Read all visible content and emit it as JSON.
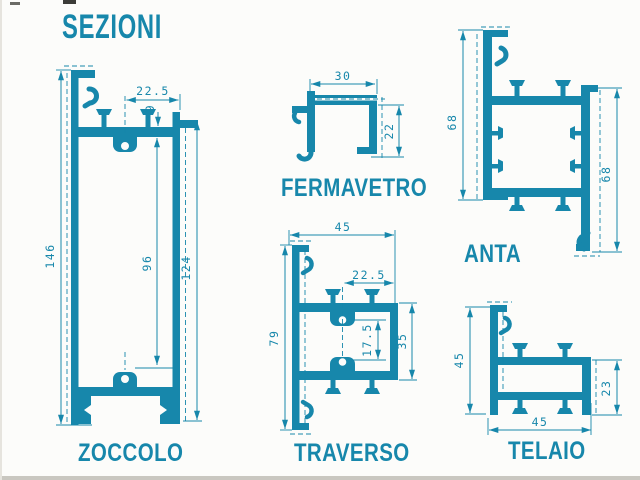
{
  "title": "SEZIONI",
  "colors": {
    "accent": "#1787ab"
  },
  "profiles": {
    "zoccolo": {
      "label": "ZOCCOLO",
      "dims": {
        "d225": "22.5",
        "d9": "9",
        "d146": "146",
        "d96": "96",
        "d124": "124"
      }
    },
    "fermavetro": {
      "label": "FERMAVETRO",
      "dims": {
        "d30": "30",
        "d22": "22"
      }
    },
    "anta": {
      "label": "ANTA",
      "dims": {
        "d68_left": "68",
        "d68_right": "68"
      }
    },
    "traverso": {
      "label": "TRAVERSO",
      "dims": {
        "d45": "45",
        "d225": "22.5",
        "d79": "79",
        "d175": "17.5",
        "d35": "35"
      }
    },
    "telaio": {
      "label": "TELAIO",
      "dims": {
        "d45_left": "45",
        "d23": "23",
        "d45_bottom": "45"
      }
    }
  }
}
